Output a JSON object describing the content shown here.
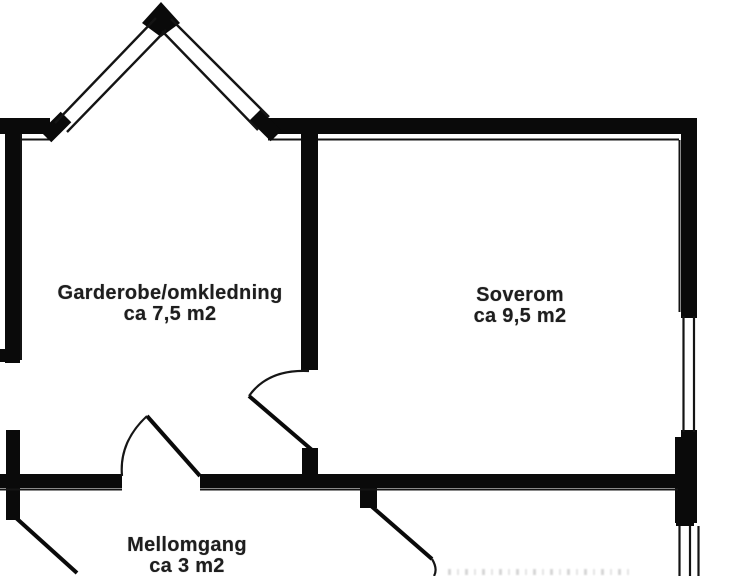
{
  "meta": {
    "type": "architectural floor plan (cropped scan)",
    "language": "Norwegian"
  },
  "colors": {
    "background": "#ffffff",
    "wall": "#0a0a0a",
    "thin_line": "#141414",
    "text": "#1e1e1e"
  },
  "rooms": {
    "garderobe": {
      "name": "Garderobe/omkledning",
      "area": "ca 7,5 m2"
    },
    "soverom": {
      "name": "Soverom",
      "area": "ca 9,5 m2"
    },
    "mellomgang": {
      "name": "Mellomgang",
      "area": "ca 3 m2"
    }
  }
}
